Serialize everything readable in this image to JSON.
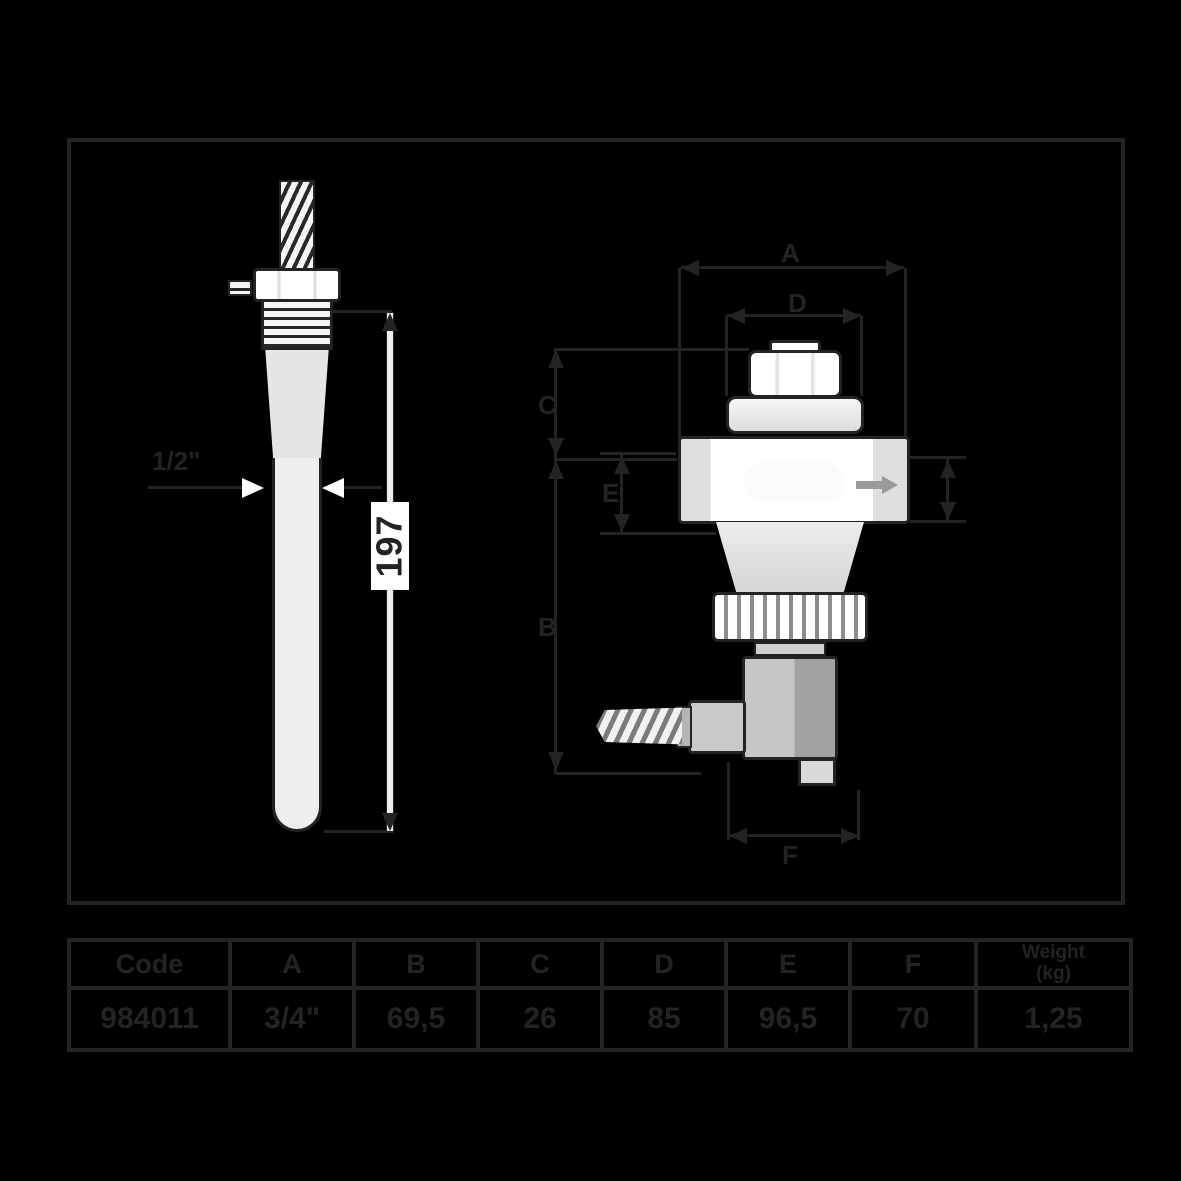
{
  "colors": {
    "background": "#000000",
    "ink": "#262223",
    "part_fill": "#ffffff",
    "part_shade": "#d9d9d9",
    "flow_arrow": "#9a9a9a"
  },
  "left_view": {
    "name": "immersion well side view",
    "diameter_label": "1/2\"",
    "length_label": "197"
  },
  "right_view": {
    "name": "thermostatic valve with remote sensor",
    "dim_a": "A",
    "dim_b": "B",
    "dim_c": "C",
    "dim_d": "D",
    "dim_e": "E",
    "dim_f": "F",
    "flow_arrow_icon": "flow-direction-arrow"
  },
  "table": {
    "headers": [
      "Code",
      "A",
      "B",
      "C",
      "D",
      "E",
      "F"
    ],
    "weight_header": {
      "line1": "Weight",
      "line2": "(kg)"
    },
    "values": [
      "984011",
      "3/4\"",
      "69,5",
      "26",
      "85",
      "96,5",
      "70",
      "1,25"
    ]
  }
}
